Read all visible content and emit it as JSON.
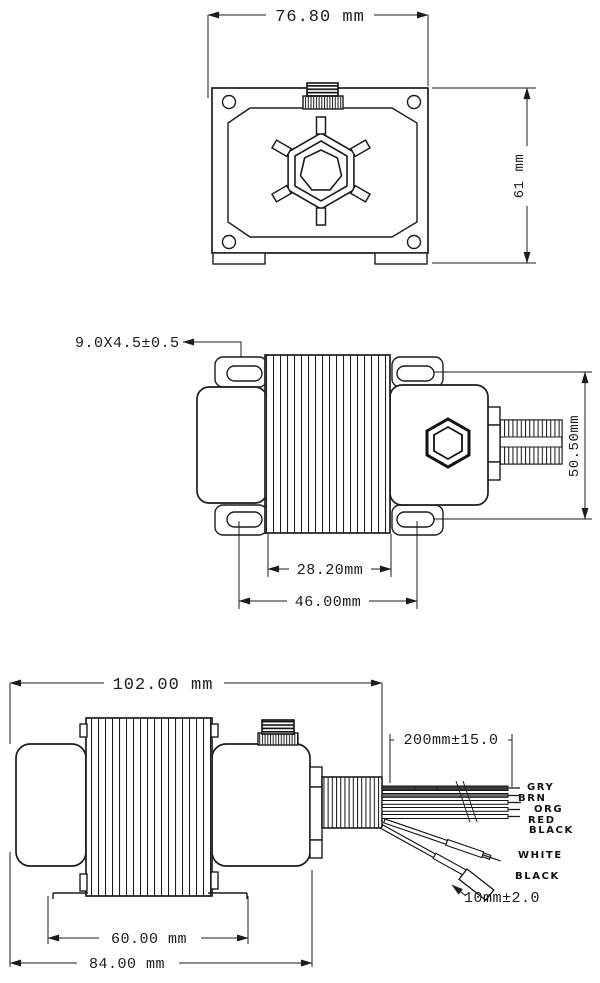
{
  "drawing": {
    "type": "engineering-dimensional-drawing",
    "unit": "mm",
    "top_view": {
      "width_dim": "76.80 mm",
      "height_dim": "61 mm"
    },
    "mount_view": {
      "slot_dim": "9.0X4.5±0.5",
      "slot_vertical_pitch_dim": "50.50mm",
      "core_width_dim": "28.20mm",
      "slot_horizontal_pitch_dim": "46.00mm"
    },
    "front_view": {
      "overall_length_dim": "102.00 mm",
      "lead_length_dim": "200mm±15.0",
      "terminal_length_dim": "10mm±2.0",
      "foot_spacing_dim": "60.00 mm",
      "body_length_dim": "84.00 mm",
      "wire_labels": [
        "GRY",
        "BRN",
        "ORG",
        "RED",
        "BLACK",
        "WHITE",
        "BLACK"
      ]
    },
    "colors": {
      "ink": "#1c1c1c",
      "paper": "#ffffff"
    }
  }
}
